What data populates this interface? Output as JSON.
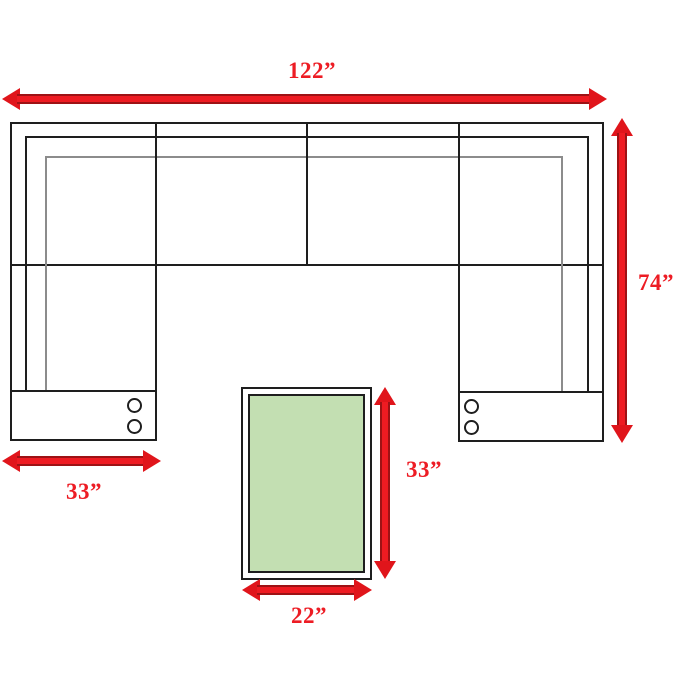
{
  "diagram": {
    "type": "sectional-sofa-dimension-diagram",
    "background": "#ffffff"
  },
  "colors": {
    "arrow_fill": "#ee1b22",
    "arrow_edge": "#9e1215",
    "label_red": "#ed1c24",
    "outline_black": "#1e1e1e",
    "cushion_gray": "#8c8c8c",
    "ottoman_green": "#c3dfb2"
  },
  "dimensions": {
    "overall_width": "122”",
    "overall_depth": "74”",
    "chaise_width": "33”",
    "ottoman_length": "33”",
    "ottoman_width": "22”"
  }
}
